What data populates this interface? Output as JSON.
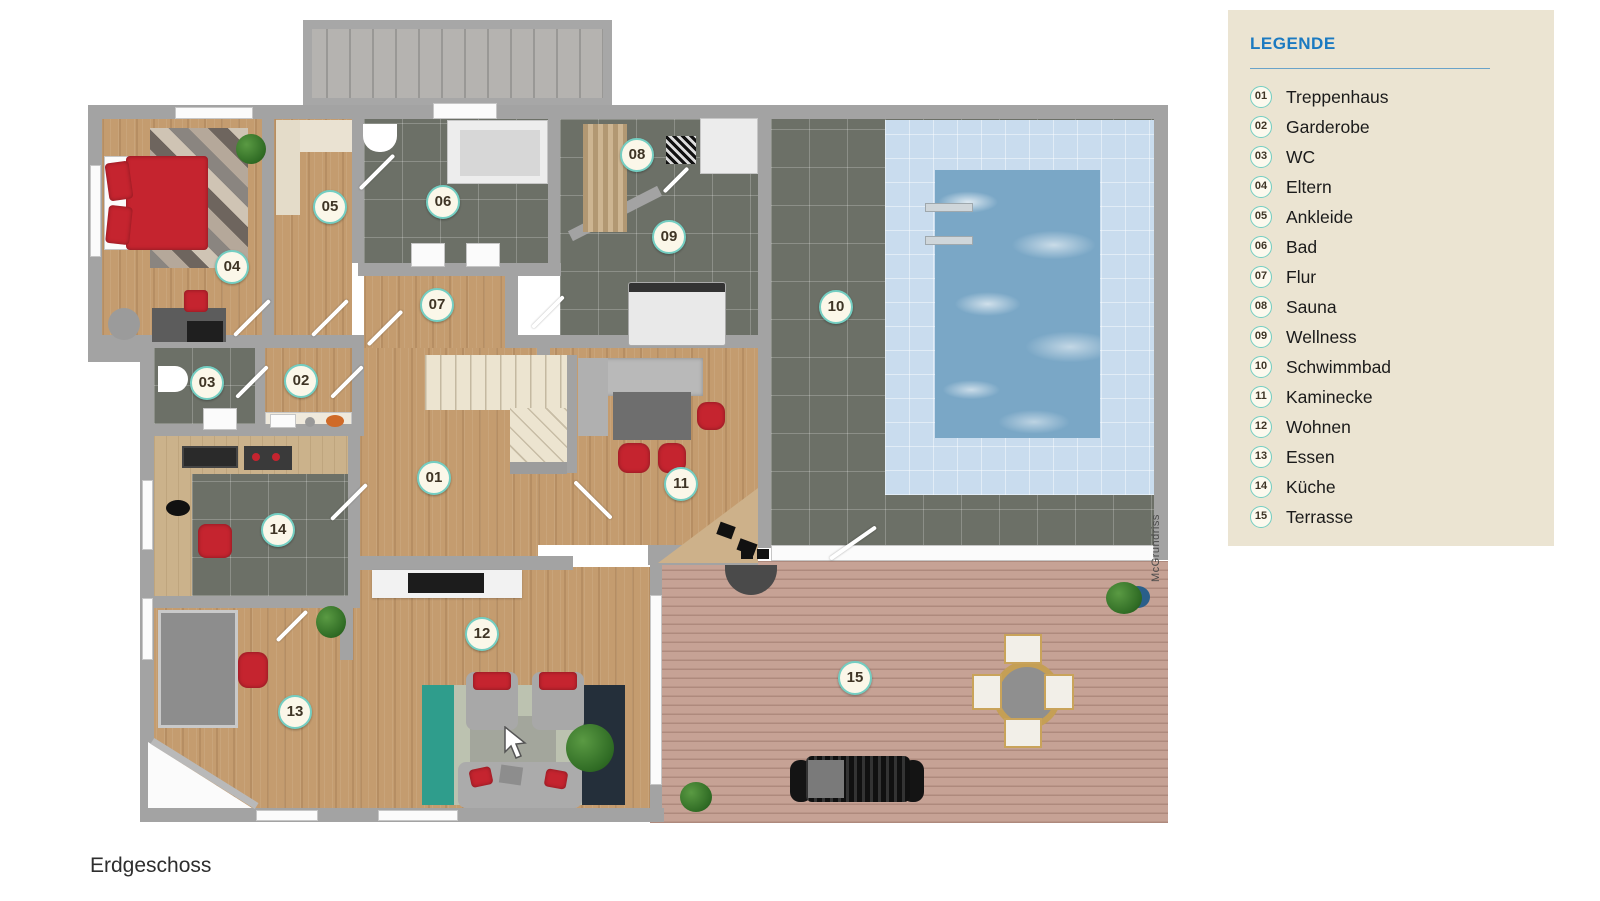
{
  "legend": {
    "title": "LEGENDE",
    "items": [
      {
        "number": "01",
        "label": "Treppenhaus"
      },
      {
        "number": "02",
        "label": "Garderobe"
      },
      {
        "number": "03",
        "label": "WC"
      },
      {
        "number": "04",
        "label": "Eltern"
      },
      {
        "number": "05",
        "label": "Ankleide"
      },
      {
        "number": "06",
        "label": "Bad"
      },
      {
        "number": "07",
        "label": "Flur"
      },
      {
        "number": "08",
        "label": "Sauna"
      },
      {
        "number": "09",
        "label": "Wellness"
      },
      {
        "number": "10",
        "label": "Schwimmbad"
      },
      {
        "number": "11",
        "label": "Kaminecke"
      },
      {
        "number": "12",
        "label": "Wohnen"
      },
      {
        "number": "13",
        "label": "Essen"
      },
      {
        "number": "14",
        "label": "Küche"
      },
      {
        "number": "15",
        "label": "Terrasse"
      }
    ]
  },
  "plan": {
    "watermark": "McGrundriss",
    "badges": [
      {
        "number": "01",
        "x": 434,
        "y": 478
      },
      {
        "number": "02",
        "x": 301,
        "y": 381
      },
      {
        "number": "03",
        "x": 207,
        "y": 383
      },
      {
        "number": "04",
        "x": 232,
        "y": 267
      },
      {
        "number": "05",
        "x": 330,
        "y": 207
      },
      {
        "number": "06",
        "x": 443,
        "y": 202
      },
      {
        "number": "07",
        "x": 437,
        "y": 305
      },
      {
        "number": "08",
        "x": 637,
        "y": 155
      },
      {
        "number": "09",
        "x": 669,
        "y": 237
      },
      {
        "number": "10",
        "x": 836,
        "y": 307
      },
      {
        "number": "11",
        "x": 681,
        "y": 484
      },
      {
        "number": "12",
        "x": 482,
        "y": 634
      },
      {
        "number": "13",
        "x": 295,
        "y": 712
      },
      {
        "number": "14",
        "x": 278,
        "y": 530
      },
      {
        "number": "15",
        "x": 855,
        "y": 678
      }
    ]
  },
  "floor_label": "Erdgeschoss",
  "colors": {
    "legend_bg": "#ebe4d2",
    "legend_title": "#1b7ac1",
    "badge_ring": "#74cec2",
    "badge_bg": "#fbf7e9",
    "badge_text": "#3e3425",
    "wall": "#a3a3a3",
    "wood_floor": "#c49c6f",
    "dark_tile": "#6c7067",
    "pool_water": "#7aa7c6",
    "pool_deck": "#c9dcee",
    "terrace_deck": "#c6a295",
    "accent_red": "#c5242f"
  }
}
